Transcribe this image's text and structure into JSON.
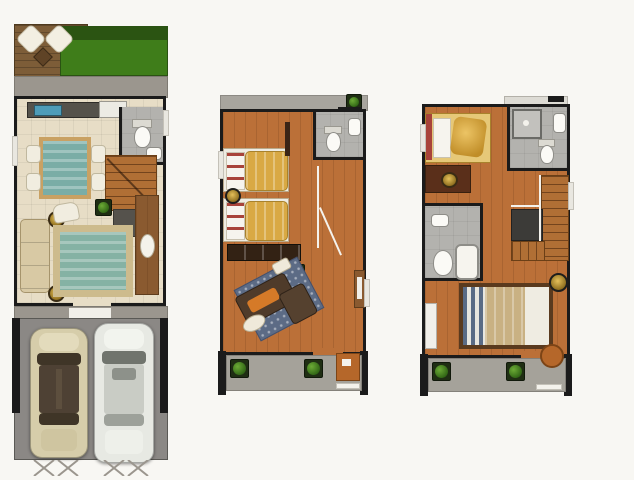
{
  "meta": {
    "description": "Top-view architectural floor plans of a three-storey townhouse, three plans side by side, no text labels",
    "floors_count": 3
  },
  "palette": {
    "background": "#f8f7f3",
    "wall": "#1b1b1b",
    "deck_wood": "#7d5d38",
    "lawn": "#3f7d1a",
    "shrub": "#2a5212",
    "patio_concrete": "#9b968e",
    "interior_tile": "#e7ddc6",
    "kitchen_counter": "#55524b",
    "sink_blue": "#4e9cb8",
    "bath_tile": "#b3b2ae",
    "dining_table_teal": "#7aada6",
    "stair_wood": "#b06f35",
    "sofa_beige": "#d8c9a4",
    "rug_teal": "#85b2a4",
    "rug_border": "#cdbb8d",
    "wood_floor": "#bb7038",
    "wardrobe_brown": "#332214",
    "sofa_brown": "#4f3b2a",
    "cushion_orange": "#d57a28",
    "rug_blue": "#5c6b85",
    "plant_green": "#3c7a1b",
    "balcony_concrete": "#a5a29a",
    "ledge_concrete": "#a8a59e",
    "garage_concrete": "#8b8885",
    "stair_landing": "#3c3b38",
    "car_beige": "#d6cdaa",
    "car_white": "#e7e9e3",
    "terracotta": "#b5672a",
    "bed_linen": "#efece2",
    "pillow_gold": "#d9a944",
    "headboard_red": "#a8433a",
    "blanket_tan": "#c9b183",
    "stripe_blue": "#5a6b85",
    "under_stair": "#55524c",
    "dark_wood": "#5a2f1a"
  },
  "floors": [
    {
      "id": "ground",
      "name": "Ground floor plan: rear wood deck and lawn, kitchen, toilet-bath, dining area, staircase, living room, two-car carport with gate",
      "rooms": [
        "garden-deck",
        "lawn",
        "rear-patio",
        "kitchen",
        "toilet-bath",
        "dining-area",
        "staircase",
        "living-room",
        "entry",
        "carport"
      ],
      "furniture": [
        "lounge-chair",
        "lounge-chair",
        "patio-table",
        "kitchen-counter",
        "kitchen-sink",
        "refrigerator",
        "toilet",
        "lavatory",
        "dining-table",
        "dining-chair-x4",
        "stair-plant",
        "sofa",
        "armchair",
        "area-rug",
        "side-table-x2",
        "console-table"
      ]
    },
    {
      "id": "second",
      "name": "Second floor plan: rear ledge, bedroom with two single beds, toilet-bath, stair hall, family area with sectional sofa, front balcony",
      "rooms": [
        "rear-ledge",
        "bedroom",
        "toilet-bath",
        "stair-hall",
        "family-area",
        "balcony"
      ],
      "furniture": [
        "plant",
        "single-bed",
        "single-bed",
        "round-nightstand",
        "toilet",
        "lavatory",
        "wardrobe",
        "sectional-sofa",
        "ottoman",
        "area-rug",
        "plant",
        "console",
        "balcony-plant-x2",
        "desk"
      ]
    },
    {
      "id": "third",
      "name": "Third floor plan: bedroom with study desk, toilet-bath with shower, staircase with landing, second toilet-bath, master bedroom, front balcony",
      "rooms": [
        "bedroom-2",
        "toilet-bath-2",
        "staircase",
        "toilet-bath-3",
        "master-bedroom",
        "balcony"
      ],
      "furniture": [
        "single-bed",
        "study-desk",
        "desk-lamp",
        "shower",
        "toilet",
        "lavatory",
        "stair-landing",
        "double-bed",
        "nightstand-lamp",
        "shelf",
        "balcony-plant-x2",
        "round-table"
      ]
    }
  ],
  "vehicles": [
    {
      "name": "sedan-beige",
      "color": "#d6cdaa"
    },
    {
      "name": "sedan-white",
      "color": "#e7e9e3"
    }
  ]
}
